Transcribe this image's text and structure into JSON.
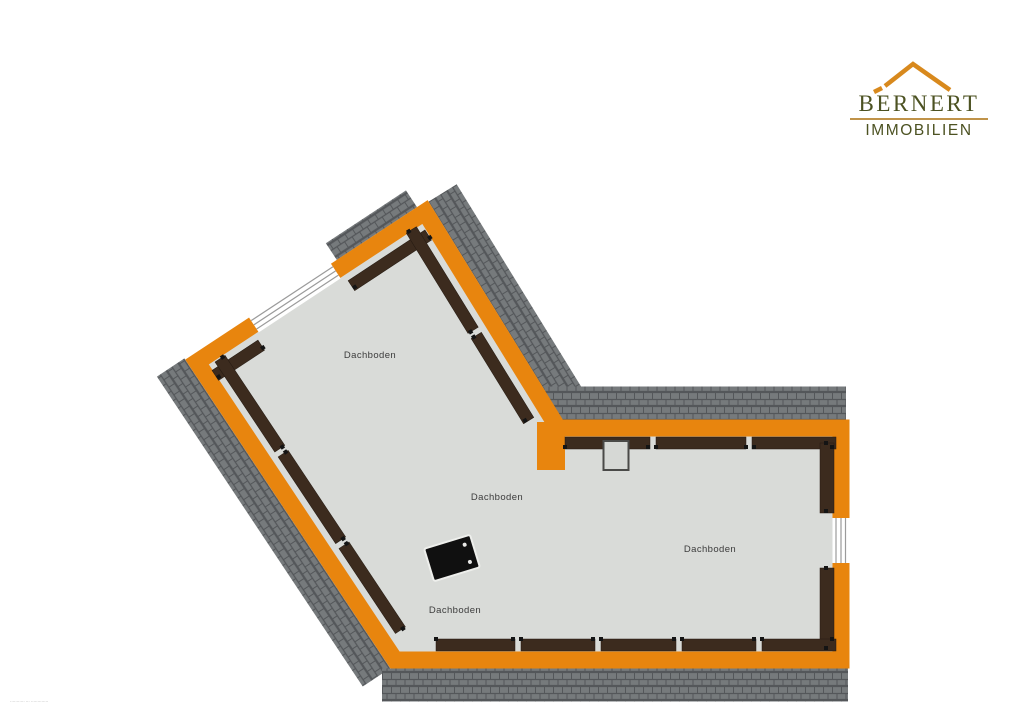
{
  "logo": {
    "title": "BERNERT",
    "subtitle": "IMMOBILIEN",
    "colors": {
      "text": "#4C5222",
      "roof": "#D8891D",
      "underline": "#C09349"
    }
  },
  "plan": {
    "room_labels": [
      {
        "label": "Dachboden"
      },
      {
        "label": "Dachboden"
      },
      {
        "label": "Dachboden"
      },
      {
        "label": "Dachboden"
      }
    ],
    "features": {
      "windows": 2,
      "chimney": 1,
      "loft_hatch": 1
    },
    "colors": {
      "wall": "#E8850E",
      "beam": "#3C2B1E",
      "floor": "#D9DBD8",
      "roof_tile": "#767A7C",
      "roof_tile_line": "#54575A",
      "label_text": "#3C3C3C"
    }
  },
  "fine_print": {
    "text": "··········· ··· ·············"
  }
}
